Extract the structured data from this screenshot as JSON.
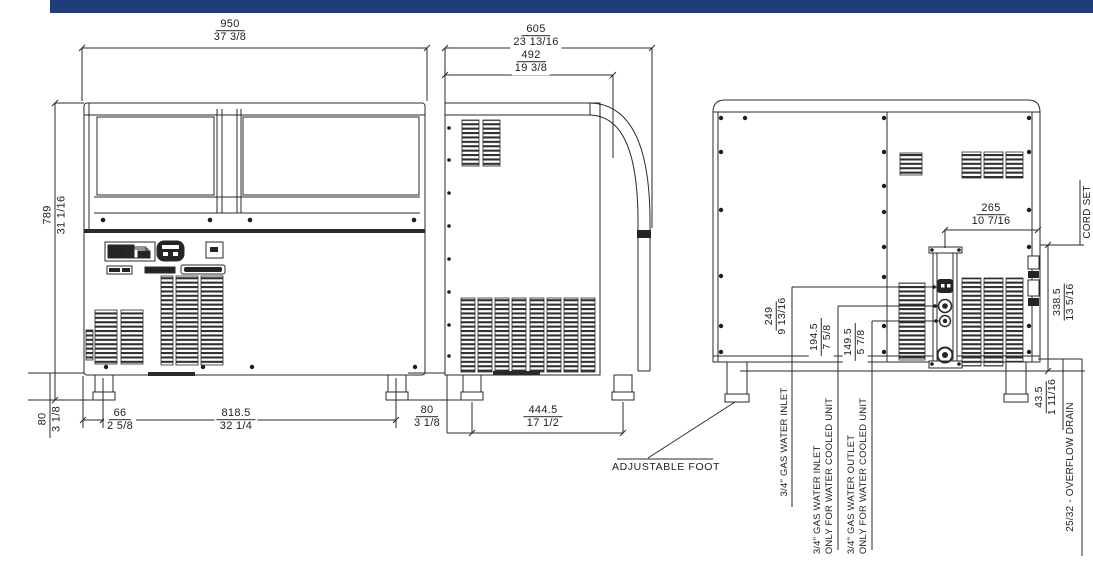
{
  "drawing": {
    "type": "ice-machine three-view dimensional drawing",
    "header_bar_color": "#1f3d78",
    "line_color": "#2a2a2a"
  },
  "front": {
    "width": {
      "mm": "950",
      "in": "37 3/8"
    },
    "height": {
      "mm": "789",
      "in": "31 1/16"
    },
    "foot_height": {
      "mm": "80",
      "in": "3 1/8"
    },
    "foot_offset": {
      "mm": "66",
      "in": "2 5/8"
    },
    "feet_span": {
      "mm": "818.5",
      "in": "32 1/4"
    }
  },
  "side": {
    "depth": {
      "mm": "605",
      "in": "23 13/16"
    },
    "top_depth": {
      "mm": "492",
      "in": "19 3/8"
    },
    "foot_height": {
      "mm": "80",
      "in": "3 1/8"
    },
    "feet_span": {
      "mm": "444.5",
      "in": "17 1/2"
    },
    "adjustable_foot_label": "ADJUSTABLE FOOT"
  },
  "rear": {
    "cord_offset": {
      "mm": "265",
      "in": "10 7/16"
    },
    "cord_height": {
      "mm": "338.5",
      "in": "13 5/16"
    },
    "water_inlet_height": {
      "mm": "249",
      "in": "9 13/16"
    },
    "cooled_inlet_height": {
      "mm": "194.5",
      "in": "7 5/8"
    },
    "cooled_outlet_height": {
      "mm": "149.5",
      "in": "5 7/8"
    },
    "drain_height": {
      "mm": "43.5",
      "in": "1 11/16"
    },
    "labels": {
      "water_inlet": "3/4\" GAS WATER INLET",
      "cooled_inlet_line1": "3/4\" GAS WATER INLET",
      "cooled_inlet_line2": "ONLY FOR WATER COOLED UNIT",
      "cooled_outlet_line1": "3/4\" GAS WATER OUTLET",
      "cooled_outlet_line2": "ONLY FOR WATER COOLED UNIT",
      "overflow_drain": "25/32 - OVERFLOW DRAIN",
      "cord_set": "CORD SET"
    }
  }
}
